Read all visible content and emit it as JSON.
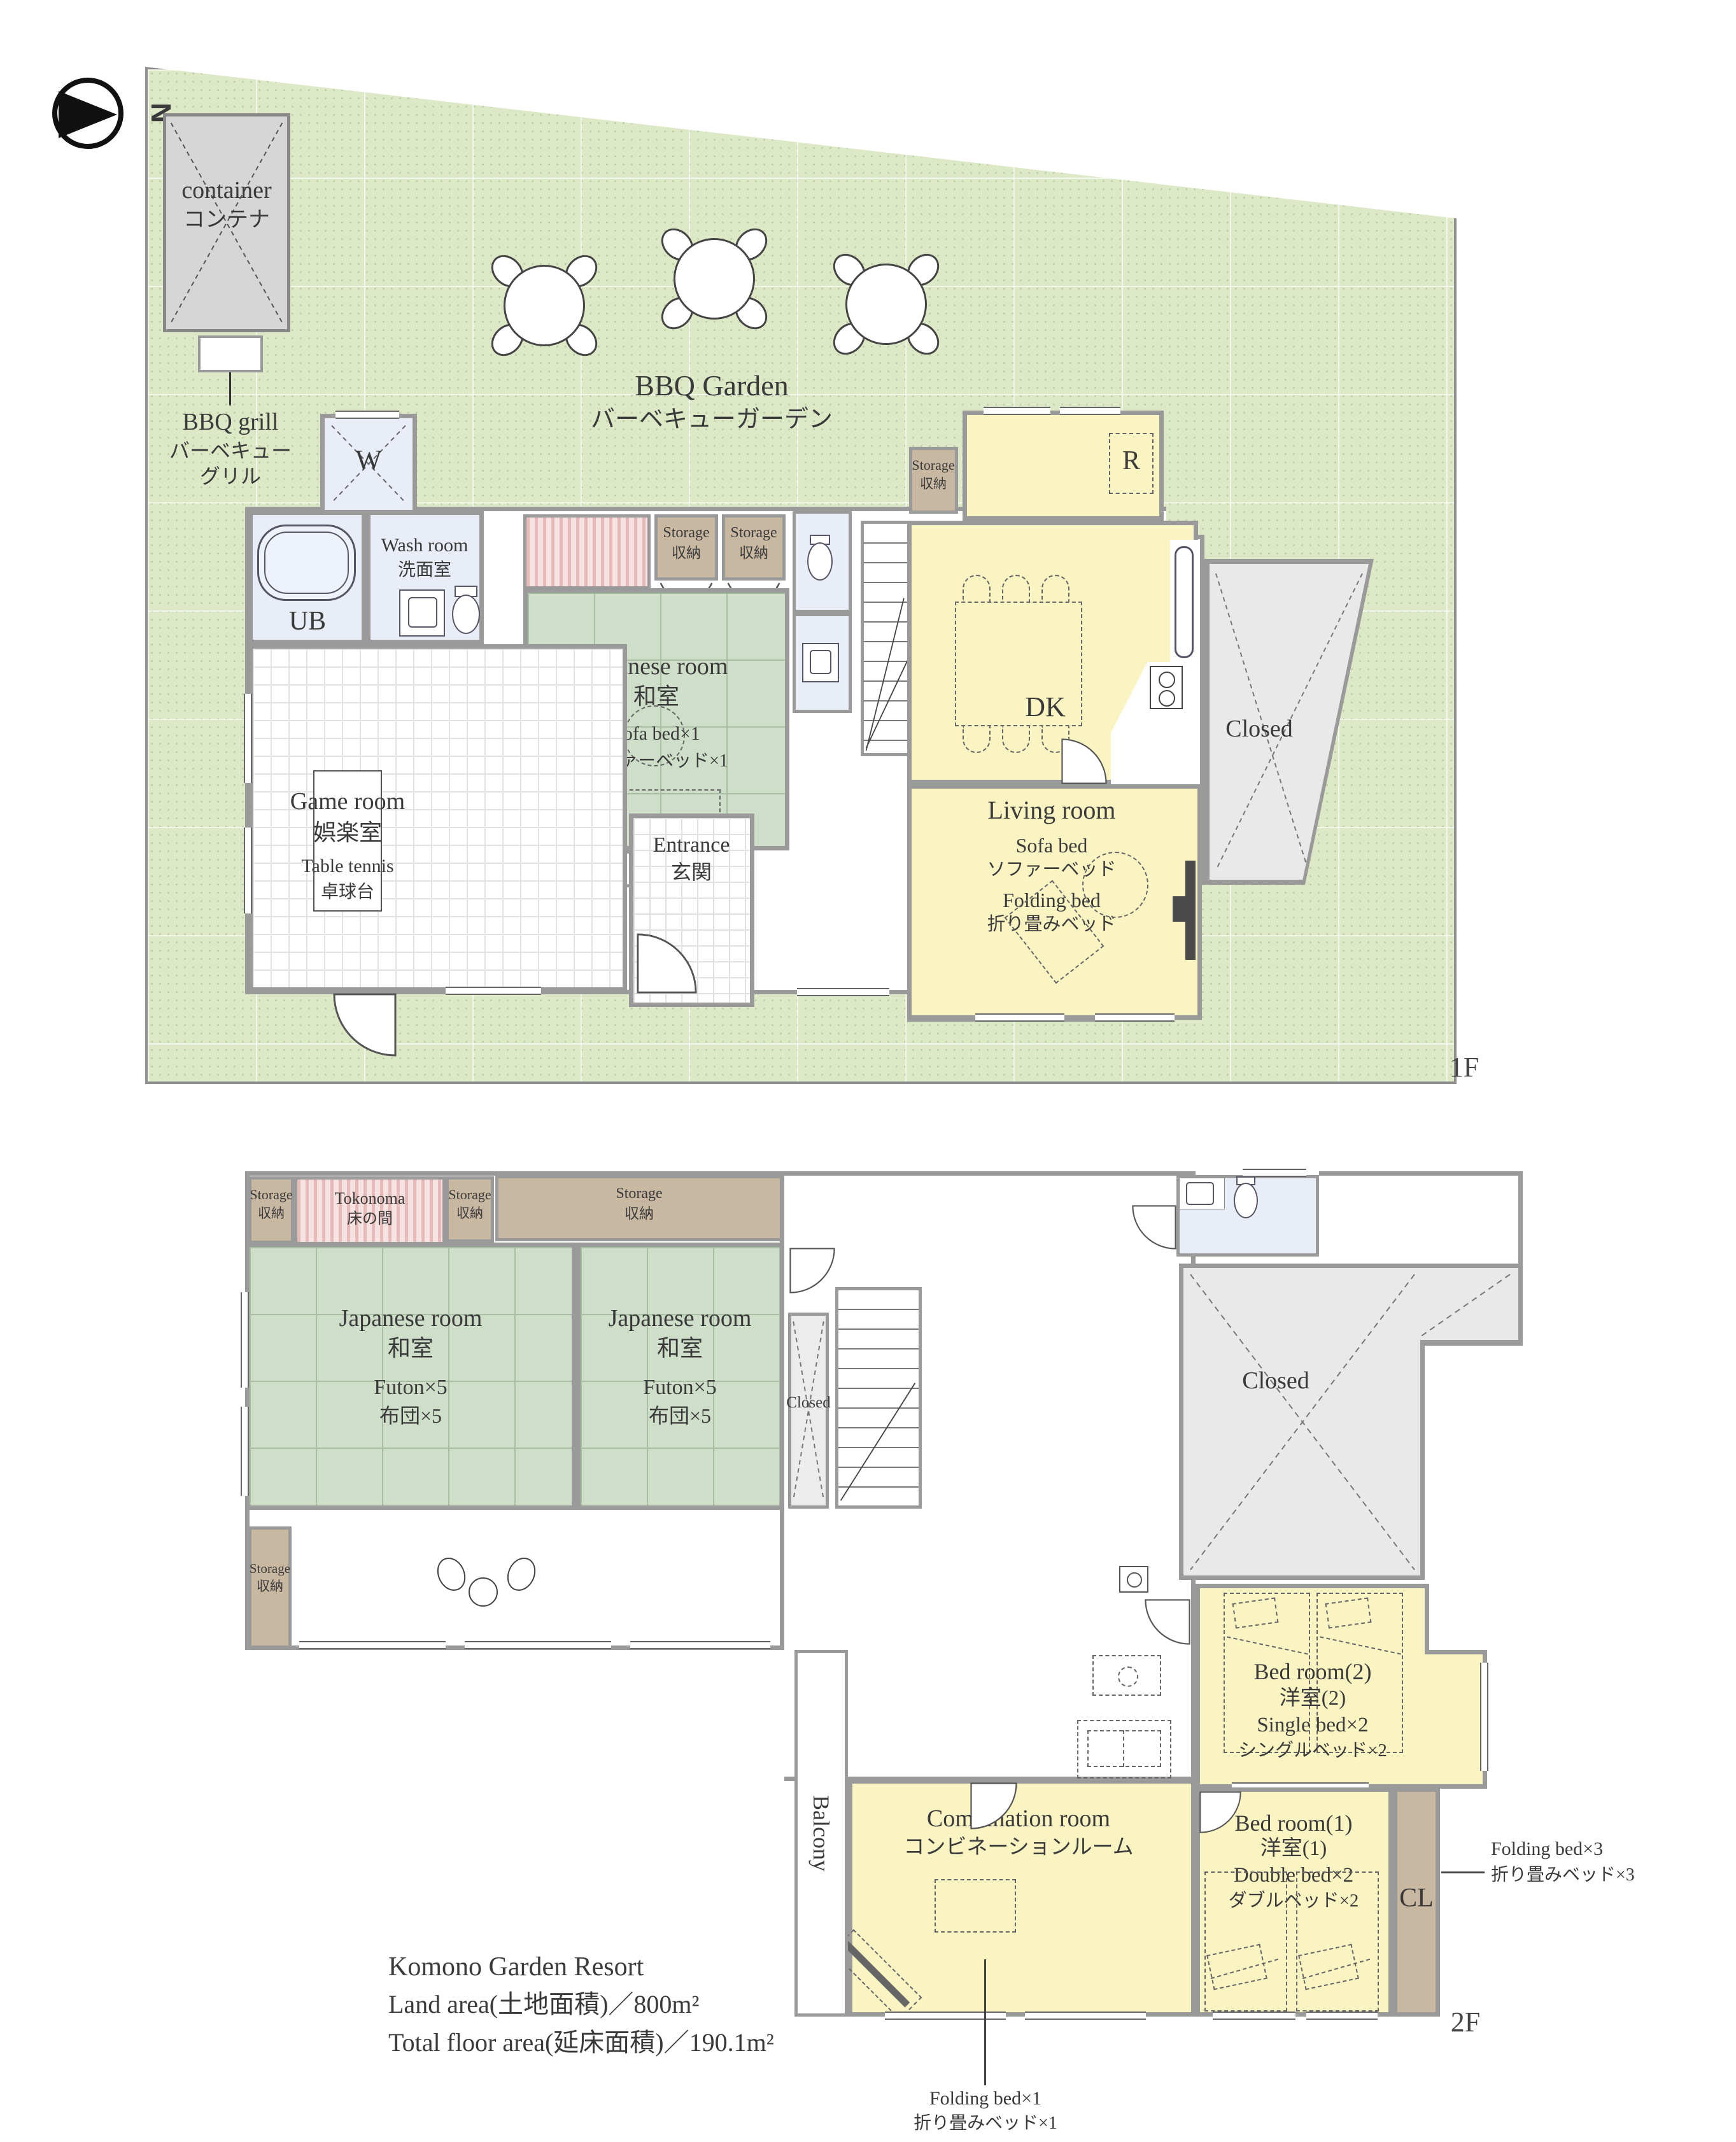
{
  "compass": {
    "letter": "N"
  },
  "floors": {
    "f1": "1F",
    "f2": "2F"
  },
  "site": {
    "bbq_garden_en": "BBQ Garden",
    "bbq_garden_ja": "バーベキューガーデン",
    "container_en": "container",
    "container_ja": "コンテナ",
    "bbq_grill_en": "BBQ grill",
    "bbq_grill_ja_1": "バーベキュー",
    "bbq_grill_ja_2": "グリル"
  },
  "shared": {
    "storage_en": "Storage",
    "storage_ja": "収納",
    "closed": "Closed",
    "japanese_room_en": "Japanese room",
    "japanese_room_ja": "和室"
  },
  "f1_rooms": {
    "w": "W",
    "ub": "UB",
    "wash_en": "Wash room",
    "wash_ja": "洗面室",
    "game_en": "Game room",
    "game_ja": "娯楽室",
    "game_item_en": "Table tennis",
    "game_item_ja": "卓球台",
    "jr_item_en": "Sofa bed×1",
    "jr_item_ja": "ソファーベッド×1",
    "entrance_en": "Entrance",
    "entrance_ja": "玄関",
    "dk": "DK",
    "fridge": "R",
    "living_en": "Living room",
    "living_item1_en": "Sofa bed",
    "living_item1_ja": "ソファーベッド",
    "living_item2_en": "Folding bed",
    "living_item2_ja": "折り畳みベッド"
  },
  "f2_rooms": {
    "tokonoma_en": "Tokonoma",
    "tokonoma_ja": "床の間",
    "jr_item_en": "Futon×5",
    "jr_item_ja": "布団×5",
    "balcony": "Balcony",
    "combo_en": "Combination room",
    "combo_ja": "コンビネーションルーム",
    "bed2_en": "Bed room(2)",
    "bed2_ja": "洋室(2)",
    "bed2_item_en": "Single bed×2",
    "bed2_item_ja": "シングルベッド×2",
    "bed1_en": "Bed room(1)",
    "bed1_ja": "洋室(1)",
    "bed1_item_en": "Double bed×2",
    "bed1_item_ja": "ダブルベッド×2",
    "cl": "CL"
  },
  "annotations": {
    "folding1_en": "Folding bed×1",
    "folding1_ja": "折り畳みベッド×1",
    "folding3_en": "Folding bed×3",
    "folding3_ja": "折り畳みベッド×3"
  },
  "title_block": {
    "name": "Komono Garden Resort",
    "land_area": "Land area(土地面積)／800m²",
    "floor_area": "Total floor area(延床面積)／190.1m²"
  },
  "colors": {
    "wall": "#9a9a9a",
    "garden_green": "#dce8c6",
    "room_yellow": "#faf4c3",
    "tatami_green": "#cedec8",
    "water_blue": "#e9edf7",
    "storage_brown": "#c9b8a1",
    "closed_gray": "#e9e9e9",
    "tokonoma_pink": "#f6e2e0"
  }
}
